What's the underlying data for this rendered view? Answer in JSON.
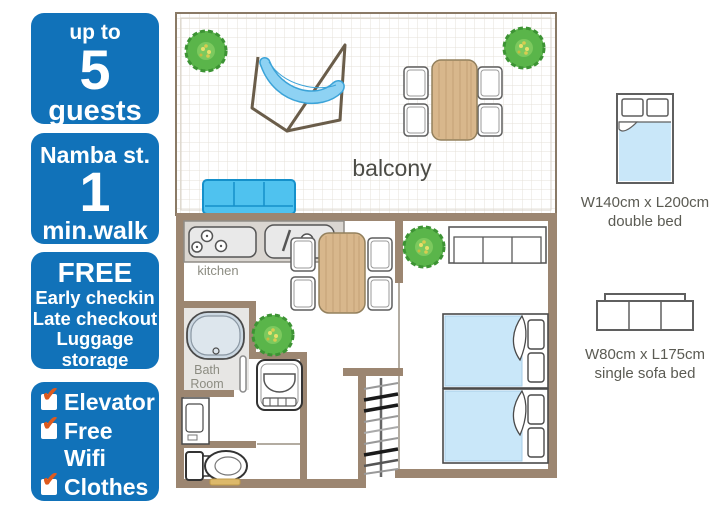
{
  "sidebar": {
    "check_glyph": "✔",
    "guests": {
      "line1": "up to",
      "number": "5",
      "line2": "guests"
    },
    "station": {
      "line1": "Namba st.",
      "number": "1",
      "line2": "min.walk"
    },
    "free": {
      "title": "FREE",
      "items": [
        "Early checkin",
        "Late checkout",
        "Luggage storage"
      ],
      "note": "depending on availability"
    },
    "amenities": [
      "Elevator",
      "Free Wifi",
      "Clothes dryer"
    ]
  },
  "plan": {
    "labels": {
      "balcony": "balcony",
      "kitchen": "kitchen",
      "bath_line1": "Bath",
      "bath_line2": "Room"
    }
  },
  "legend": {
    "double_bed": {
      "size": "W140cm x L200cm",
      "label": "double bed"
    },
    "sofa_bed": {
      "size": "W80cm x L175cm",
      "label": "single sofa bed"
    }
  },
  "colors": {
    "badge_blue": "#1172b9",
    "check_orange": "#dd5a1e",
    "wall_brown": "#9c8671",
    "bed_blue": "#c9e7f9",
    "sofa_blue": "#4fc2ef",
    "table_tan": "#d8b78c",
    "plant_green": "#5ab54a"
  }
}
